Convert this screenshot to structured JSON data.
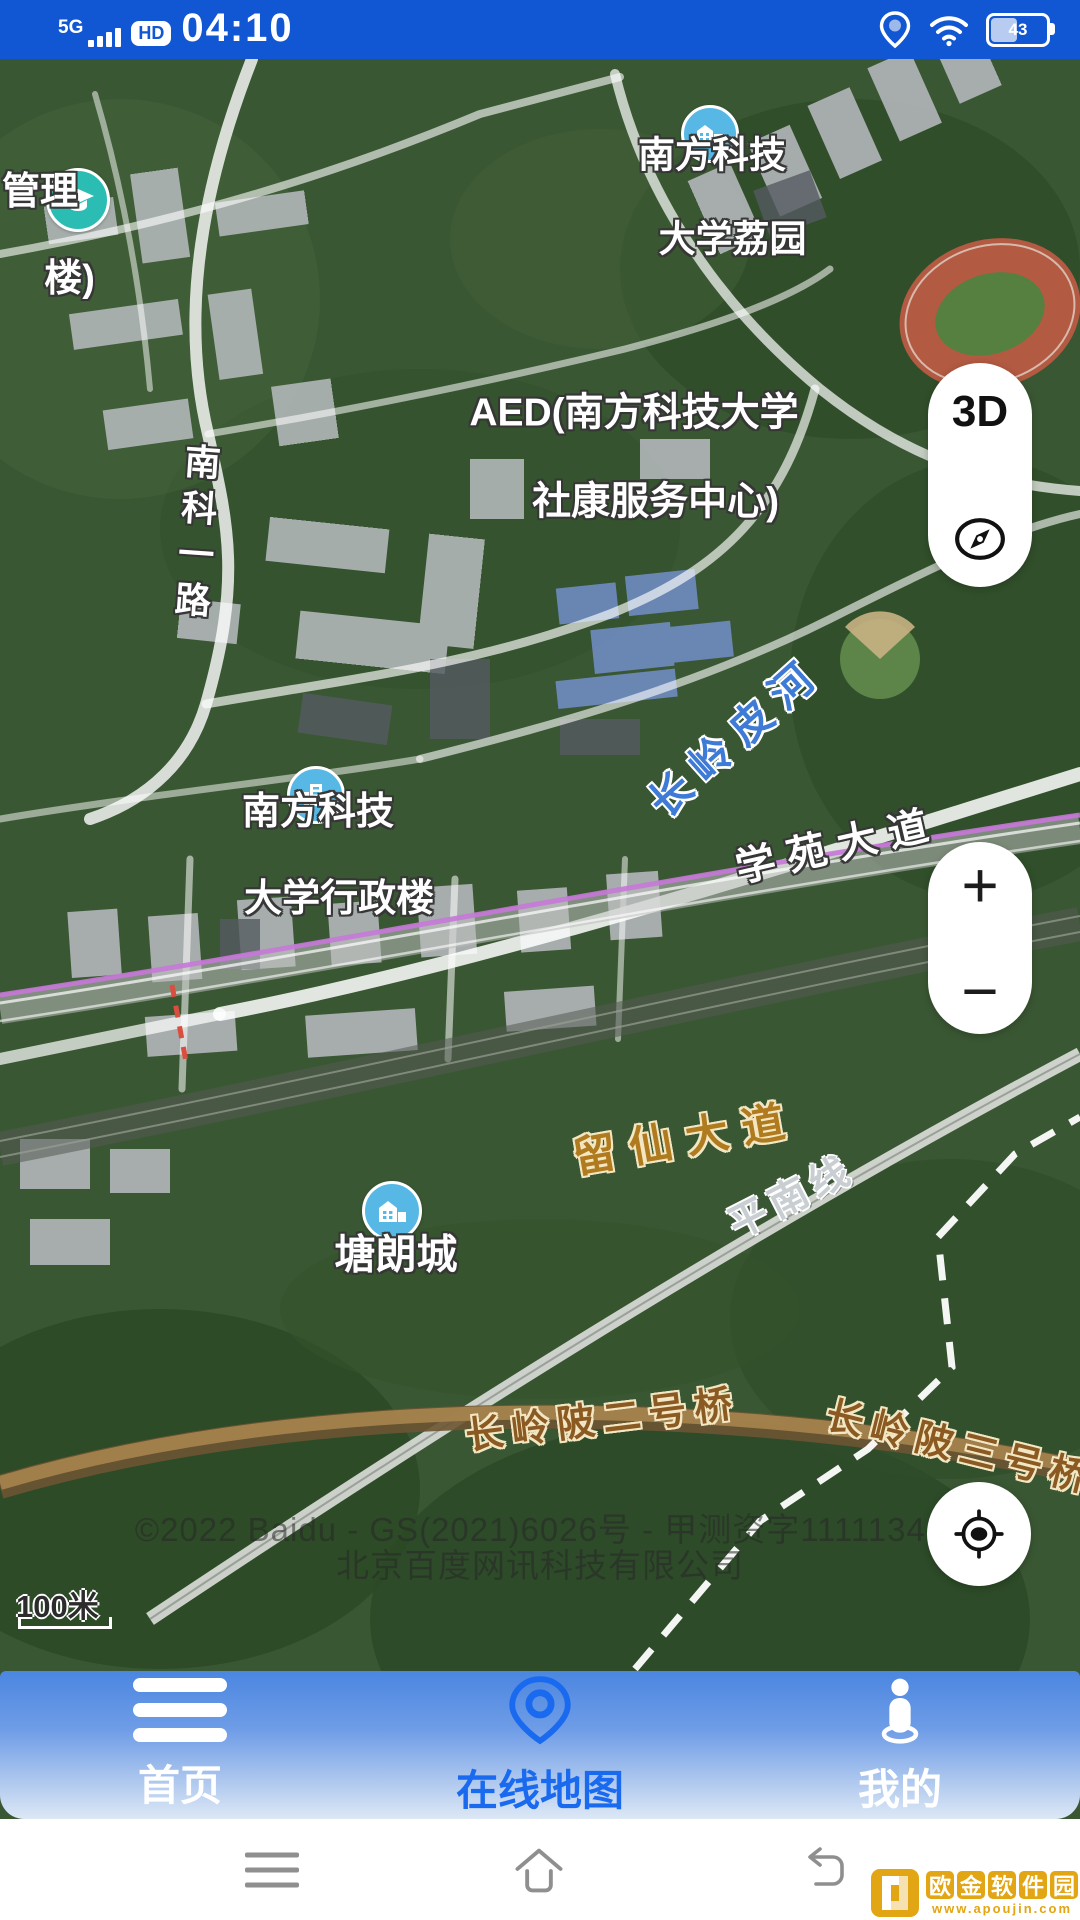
{
  "status_bar": {
    "network": "5G",
    "hd_badge": "HD",
    "time": "04:10",
    "battery_percent": "43"
  },
  "map": {
    "pois": {
      "liyuan": {
        "line1": "南方科技",
        "line2": "大学荔园"
      },
      "guanlilou": {
        "line1": "管理",
        "line2": "楼)"
      },
      "xingzhenglou": {
        "line1": "南方科技",
        "line2": "大学行政楼"
      },
      "tanglangcheng": {
        "label": "塘朗城"
      }
    },
    "aed": {
      "line1": "AED(南方科技大学",
      "line2": "社康服务中心)"
    },
    "road_labels": {
      "nanke_yilu": "南科一路",
      "changlingpi_river": "长岭皮河",
      "xueyuan_dadao": "学苑大道",
      "liuxian_dadao": "留仙大道",
      "pingnan_line": "平南线",
      "bridge_no2": "长岭陂二号桥",
      "bridge_no3": "长岭陂三号桥"
    },
    "copyright_line1": "©2022 Baidu - GS(2021)6026号 - 甲测资字11111342",
    "copyright_line2": "北京百度网讯科技有限公司",
    "scale_label": "100米"
  },
  "map_controls": {
    "threed_label": "3D",
    "zoom_in_label": "+",
    "zoom_out_label": "−"
  },
  "bottom_nav": {
    "items": [
      {
        "label": "首页"
      },
      {
        "label": "在线地图"
      },
      {
        "label": "我的"
      }
    ]
  },
  "watermark": {
    "title_chars": [
      "欧",
      "金",
      "软",
      "件",
      "园"
    ],
    "url": "www.apoujin.com"
  },
  "colors": {
    "status_bar_blue": "#1156d2",
    "accent_blue": "#1a6af0",
    "poi_icon_blue": "#57b8e6",
    "edu_icon_teal": "#2bbdb4",
    "road_label_orange": "#b07a1e",
    "bridge_label_brown": "#8a5a22",
    "river_label_blue": "#3e7bd6",
    "watermark_gold": "#e2a513"
  }
}
